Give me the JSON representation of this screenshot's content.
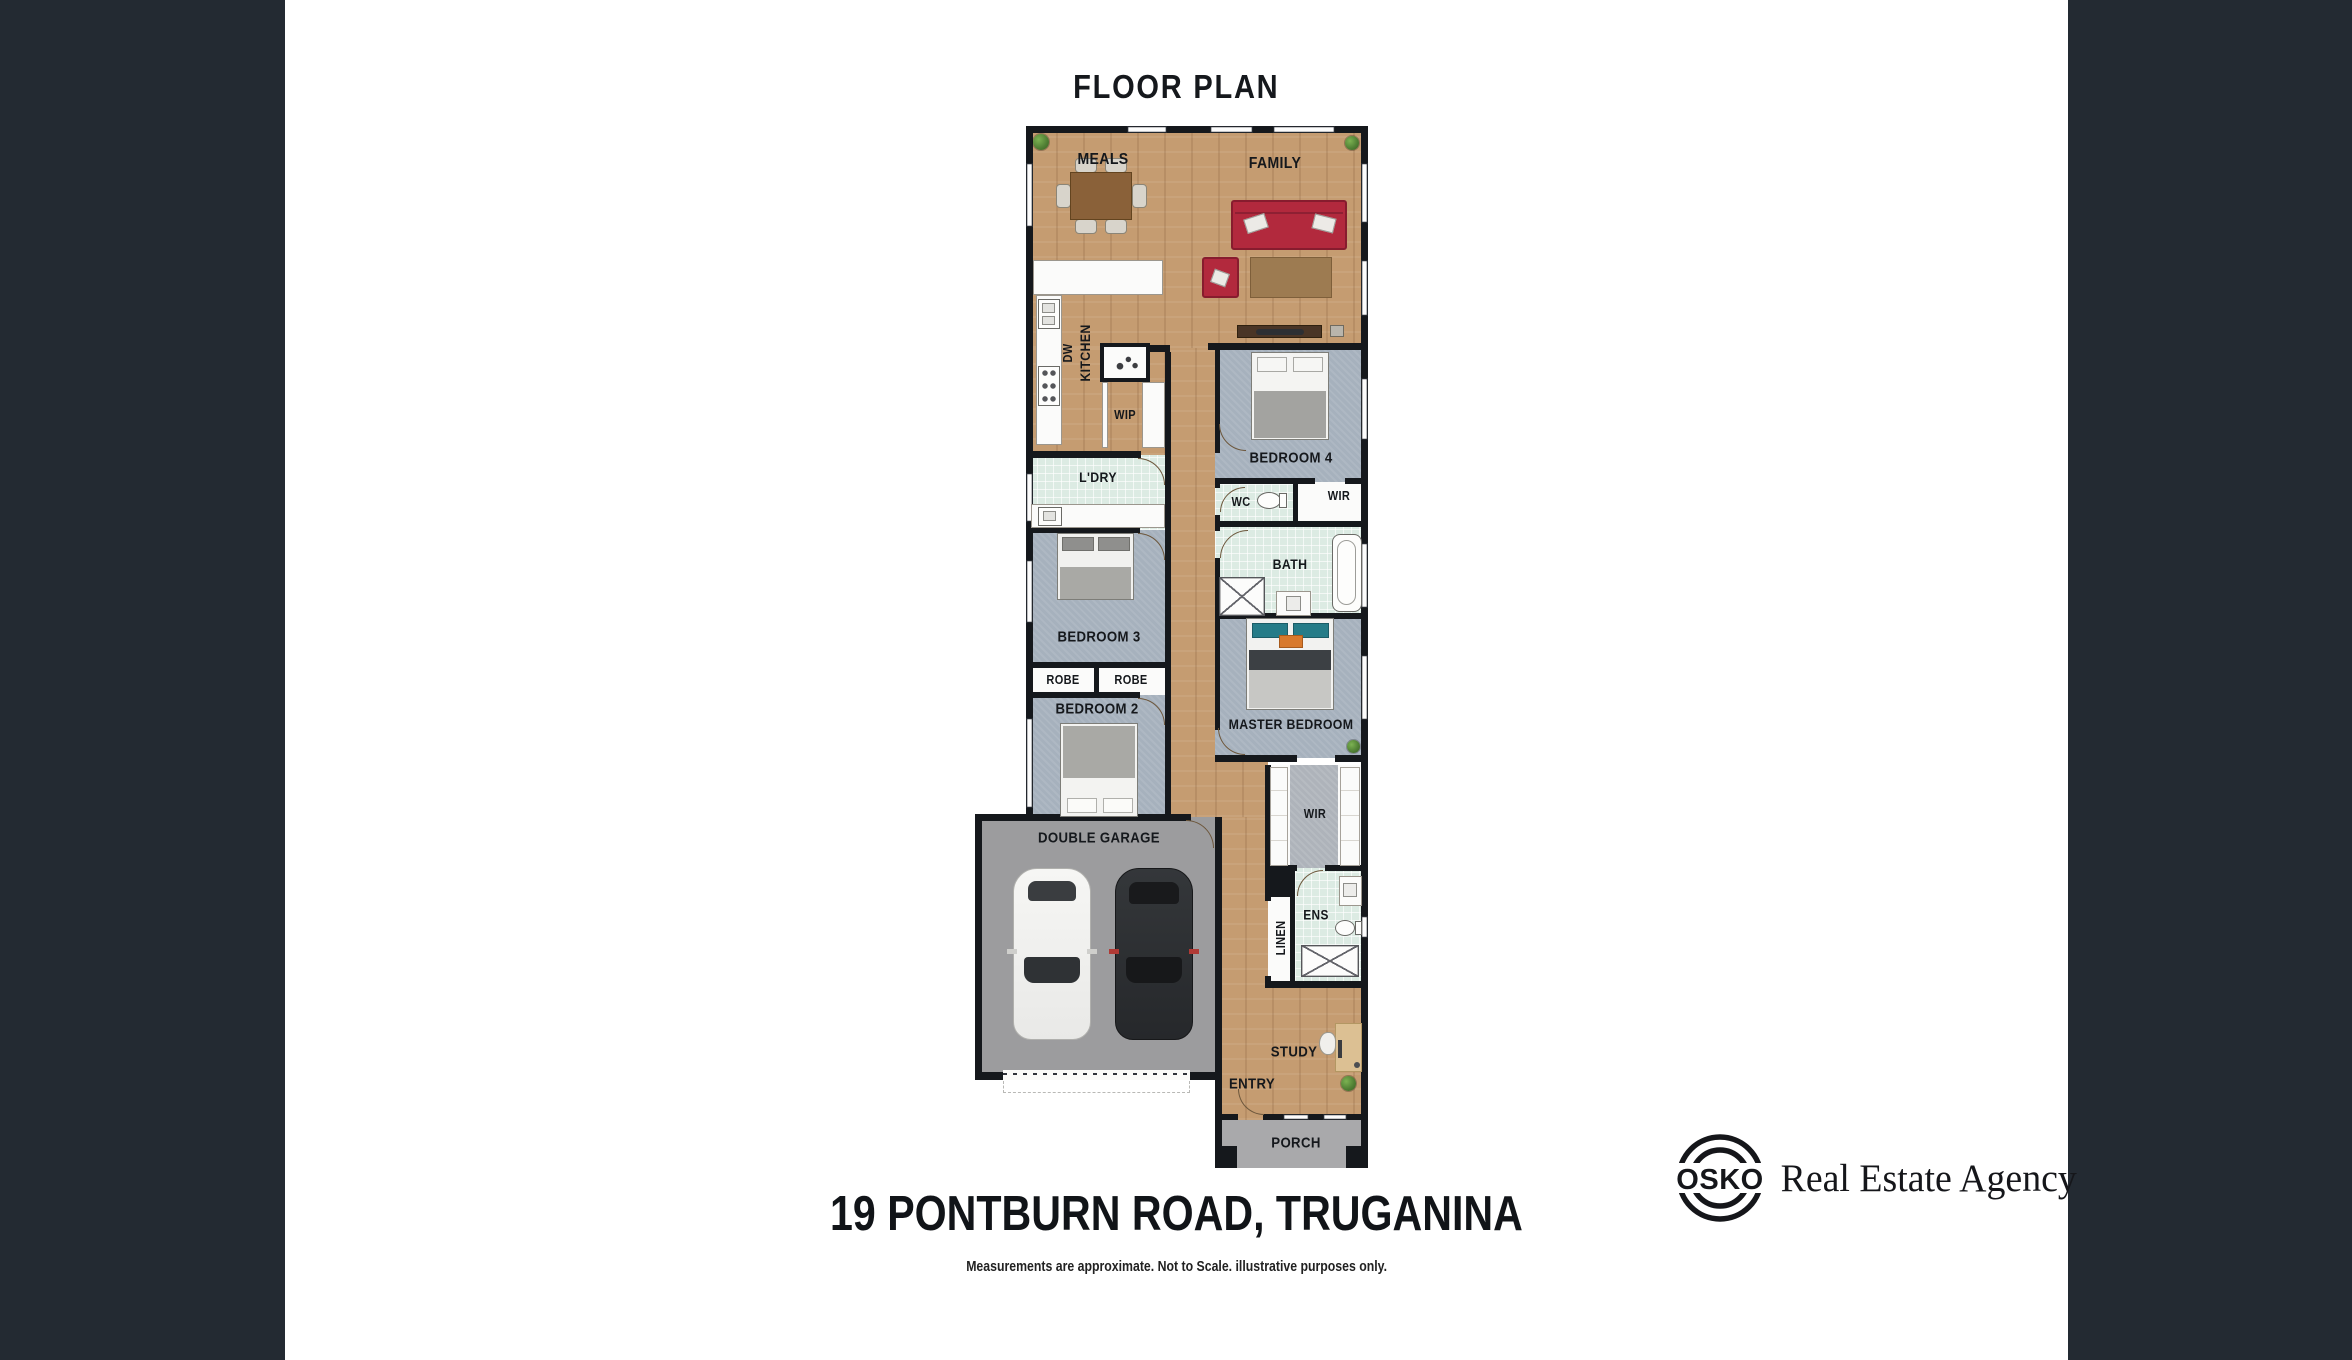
{
  "header": {
    "title": "FLOOR PLAN"
  },
  "footer": {
    "address": "19 PONTBURN ROAD, TRUGANINA",
    "disclaimer": "Measurements are approximate. Not to Scale. illustrative purposes only."
  },
  "agency": {
    "mark": "OSKO",
    "name": "Real Estate Agency"
  },
  "rooms": {
    "meals": "MEALS",
    "family": "FAMILY",
    "kitchen": "KITCHEN",
    "dishwasher": "DW",
    "pantry": "WIP",
    "laundry": "L'DRY",
    "bedroom4": "BEDROOM 4",
    "wir_bed4": "WIR",
    "wc": "WC",
    "bath": "BATH",
    "bedroom3": "BEDROOM 3",
    "robe_left": "ROBE",
    "robe_right": "ROBE",
    "bedroom2": "BEDROOM 2",
    "master_bedroom": "MASTER BEDROOM",
    "garage": "DOUBLE GARAGE",
    "wir_master": "WIR",
    "ensuite": "ENS",
    "linen": "LINEN",
    "study": "STUDY",
    "entry": "ENTRY",
    "porch": "PORCH"
  },
  "colors": {
    "panel": "#232a32",
    "wall": "#15181c",
    "wood": "#c59c71",
    "carpet": "#a6b1bd",
    "tile": "#dcebe3",
    "garage_floor": "#9c9c9e",
    "porch_floor": "#a9a9ab",
    "sofa": "#b2293d",
    "accent_teal": "#267c88",
    "accent_orange": "#d8792c"
  }
}
